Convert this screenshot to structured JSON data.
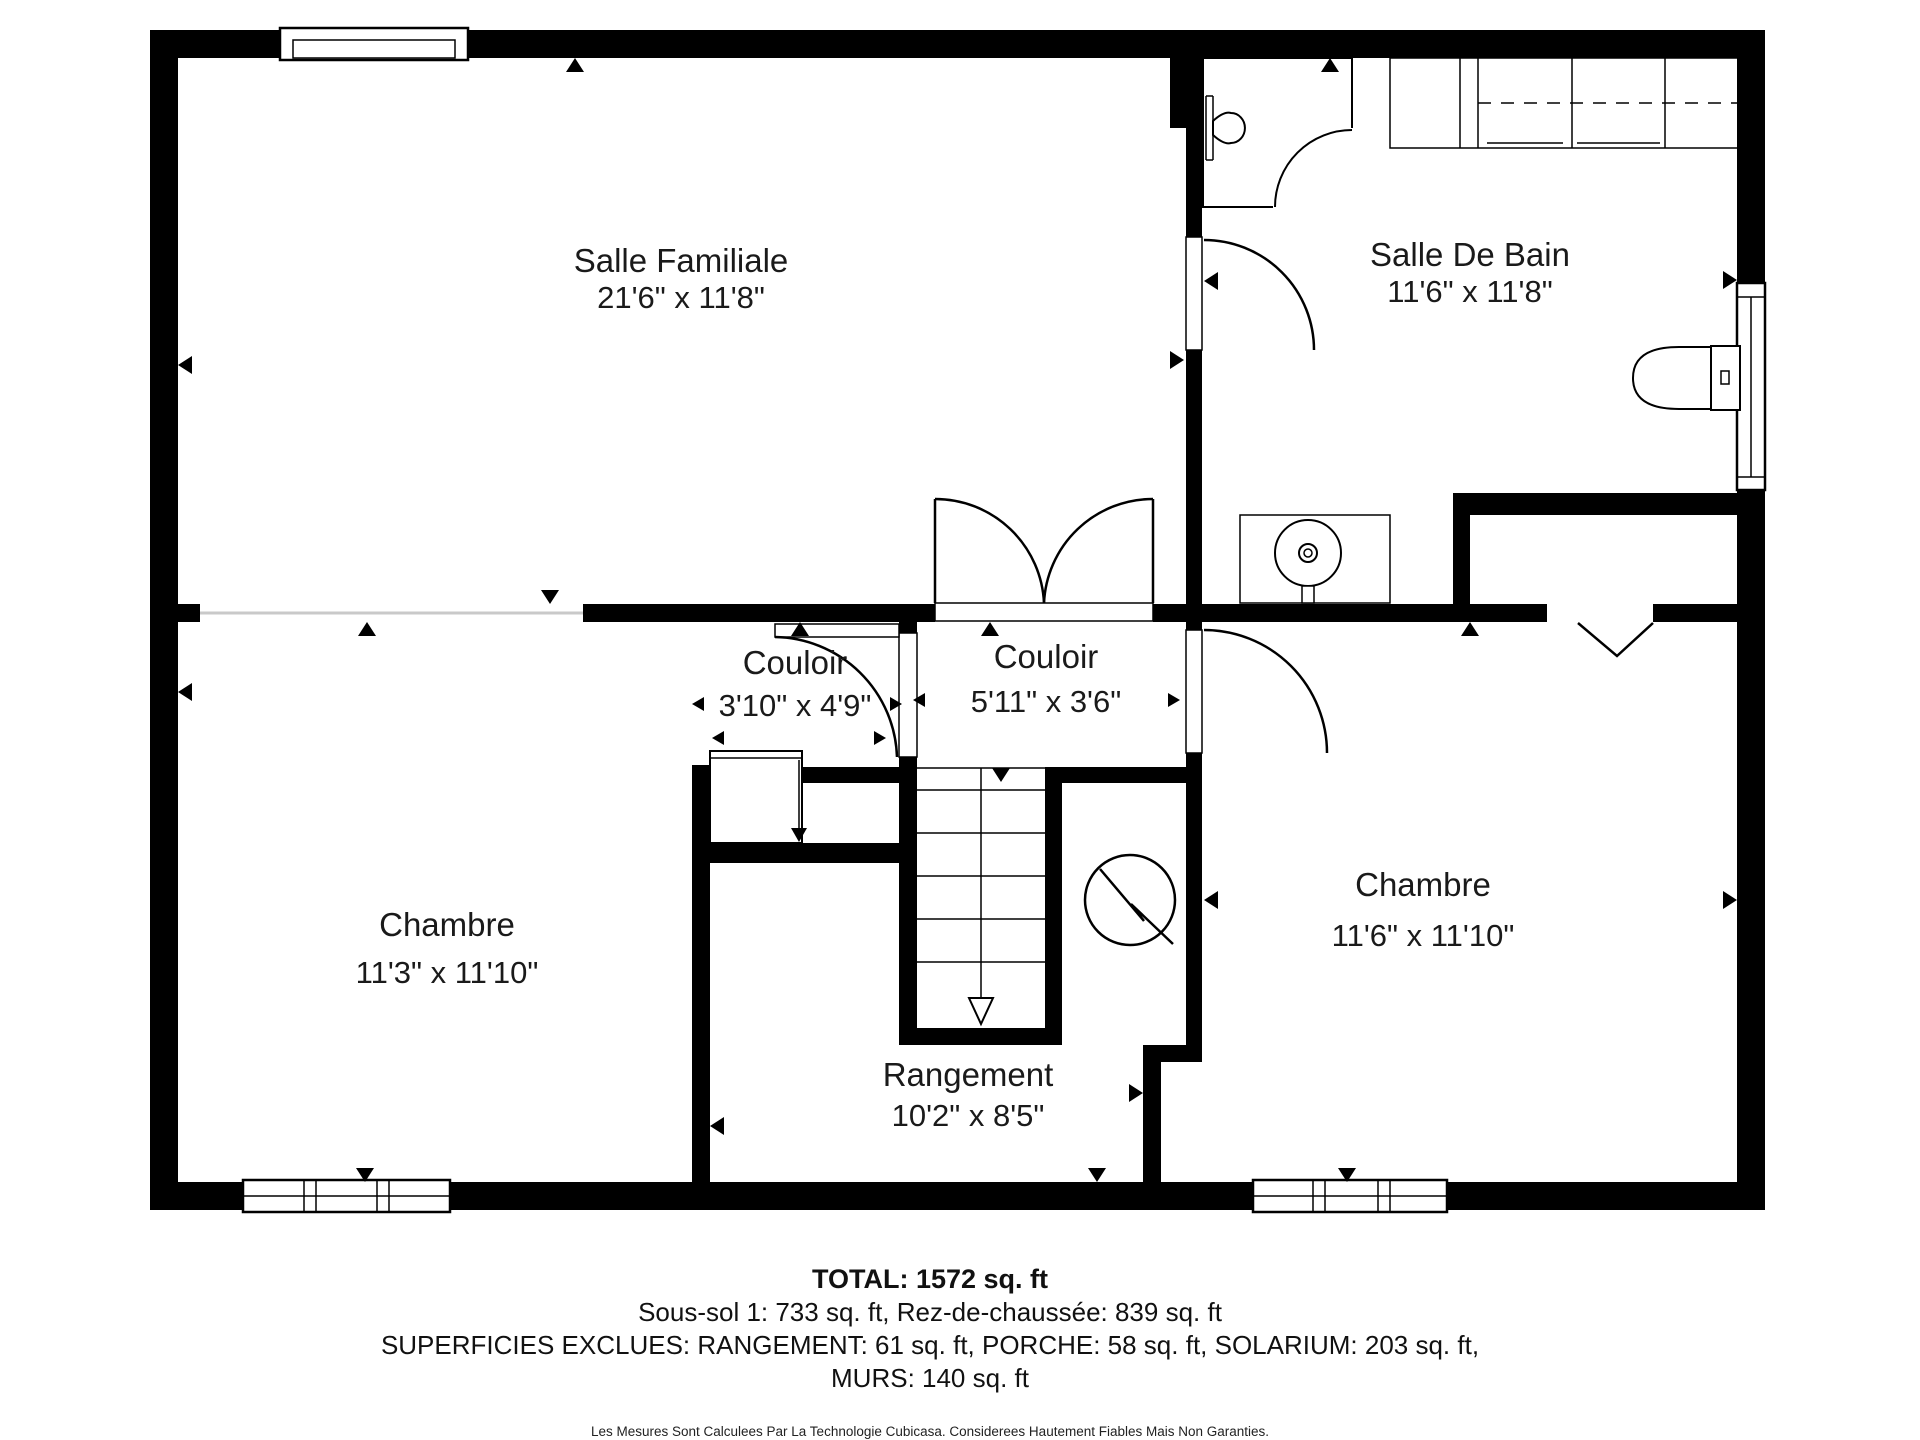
{
  "colors": {
    "wall": "#000000",
    "background": "#ffffff",
    "open_boundary": "#c9c9c9"
  },
  "rooms": [
    {
      "id": "salle-familiale",
      "name": "Salle Familiale",
      "dimensions": "21'6\" x 11'8\""
    },
    {
      "id": "salle-de-bain",
      "name": "Salle De Bain",
      "dimensions": "11'6\" x 11'8\""
    },
    {
      "id": "couloir-petit",
      "name": "Couloir",
      "dimensions": "3'10\" x 4'9\""
    },
    {
      "id": "couloir-grand",
      "name": "Couloir",
      "dimensions": "5'11\" x 3'6\""
    },
    {
      "id": "chambre-gauche",
      "name": "Chambre",
      "dimensions": "11'3\" x 11'10\""
    },
    {
      "id": "chambre-droite",
      "name": "Chambre",
      "dimensions": "11'6\" x 11'10\""
    },
    {
      "id": "rangement",
      "name": "Rangement",
      "dimensions": "10'2\" x 8'5\""
    }
  ],
  "footer": {
    "total": "TOTAL: 1572 sq. ft",
    "floors": "Sous-sol 1: 733 sq. ft, Rez-de-chaussée: 839 sq. ft",
    "excluded_line1": "SUPERFICIES EXCLUES: RANGEMENT: 61 sq. ft, PORCHE: 58 sq. ft, SOLARIUM: 203 sq. ft,",
    "excluded_line2": "MURS: 140 sq. ft",
    "disclaimer": "Les Mesures Sont Calculees Par La Technologie Cubicasa. Considerees Hautement Fiables Mais Non Garanties."
  },
  "icons": {
    "shower-icon": "corner shower enclosure with curved glass door",
    "shower-head-icon": "wall mounted shower head",
    "toilet-icon": "toilet with tank and flush button",
    "utility-sink-icon": "round utility sink set in counter",
    "counter-icon": "counter with overhead cabinets shown dashed",
    "water-heater-icon": "circle with zigzag utility symbol",
    "stairs-icon": "staircase with direction arrow pointing down",
    "closet-icon": "closet box with direction arrow",
    "double-door-icon": "double swing door with two quarter-circle arcs",
    "door-icon": "single swing door with quarter-circle arc",
    "window-icon": "window with frame lines",
    "opening-marker-icon": "small black triangle wall marker",
    "arch-opening-icon": "V-shaped open passage symbol"
  }
}
